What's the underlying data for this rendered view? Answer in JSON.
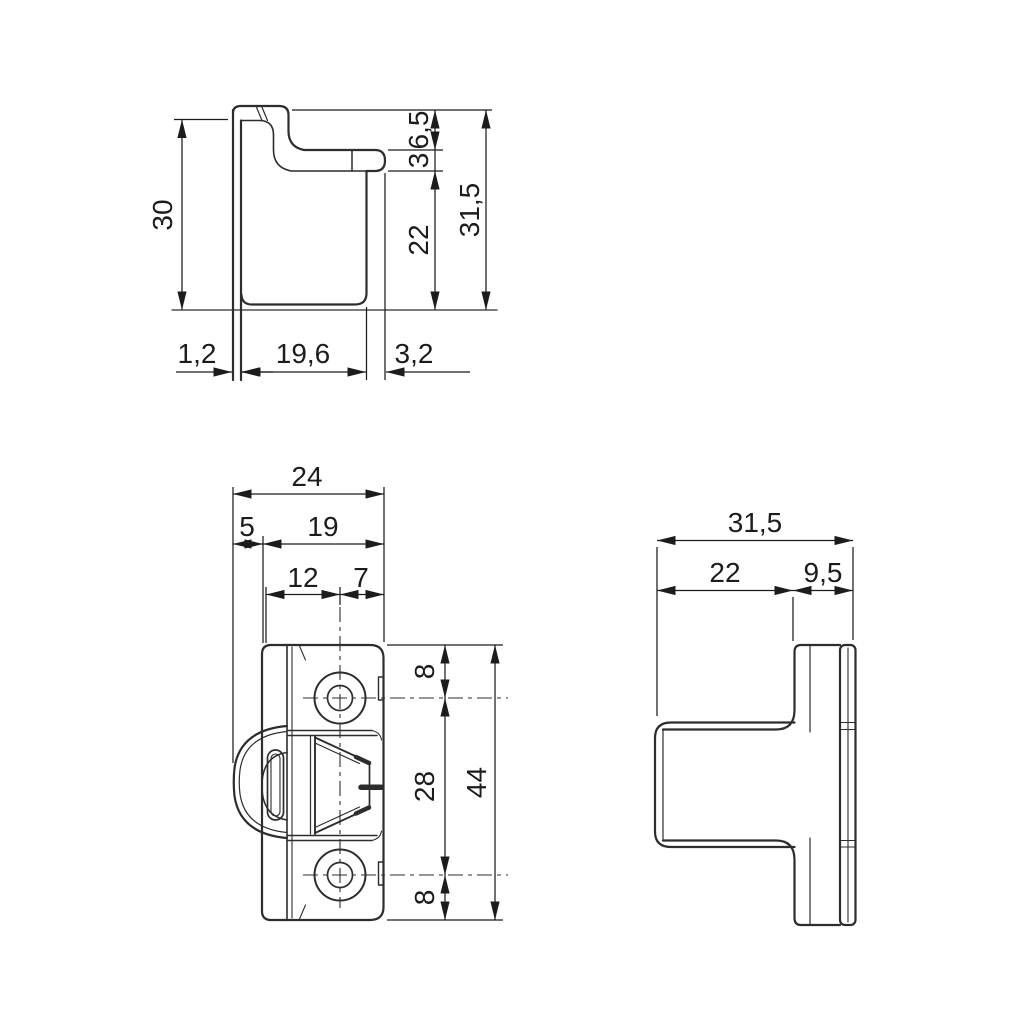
{
  "page": {
    "background": "#ffffff",
    "line_color": "#2d2d2d",
    "text_color": "#1c1c1c",
    "content": "technical drawing, three orthographic views of a hinge bracket with dimensions in mm"
  },
  "views": {
    "profile": {
      "plate_height": "30",
      "step_height": "6,5",
      "flange_thickness": "3",
      "cup_height": "22",
      "overall_height": "31,5",
      "plate_thickness": "1,2",
      "cup_depth": "19,6",
      "flange_overhang": "3,2"
    },
    "front": {
      "overall_width": "24",
      "knuckle_offset": "5",
      "plate_width": "19",
      "hole_offset_left": "12",
      "hole_offset_right": "7",
      "top_to_hole": "8",
      "hole_spacing": "28",
      "hole_to_bottom": "8",
      "overall_height": "44"
    },
    "side": {
      "overall_depth": "31,5",
      "body_depth": "22",
      "flange_depth": "9,5"
    }
  }
}
